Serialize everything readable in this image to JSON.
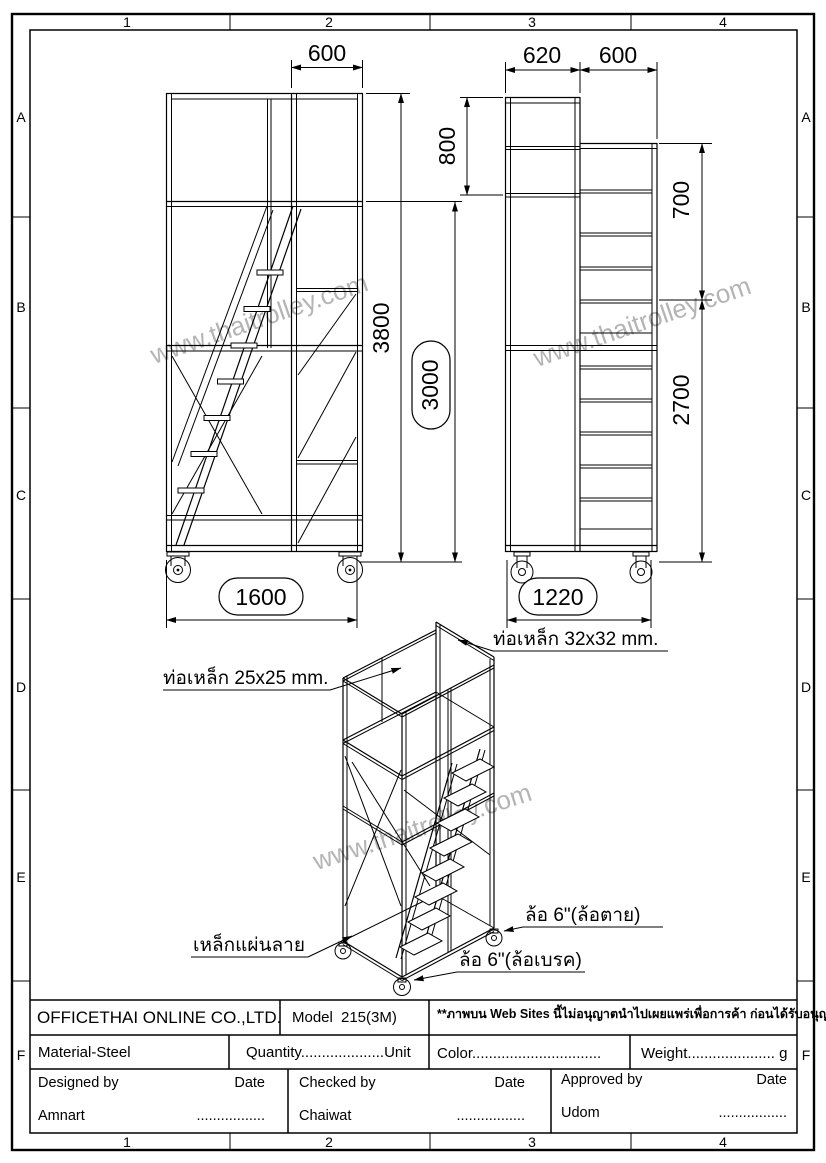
{
  "sheet": {
    "grid_cols": [
      "1",
      "2",
      "3",
      "4"
    ],
    "grid_rows": [
      "A",
      "B",
      "C",
      "D",
      "E",
      "F"
    ],
    "watermark": "www.thaitrolley.com"
  },
  "front_view": {
    "dim_top_width": "600",
    "dim_height_overall": "3800",
    "dim_height_platform": "3000",
    "dim_base_width": "1600"
  },
  "side_view": {
    "dim_top_depth": "620",
    "dim_top_width": "600",
    "dim_upper_left": "800",
    "dim_upper_right": "700",
    "dim_lower_right": "2700",
    "dim_base_depth": "1220"
  },
  "iso_view": {
    "label_tube_25": "ท่อเหล็ก 25x25 mm.",
    "label_tube_32": "ท่อเหล็ก 32x32 mm.",
    "label_plate": "เหล็กแผ่นลาย",
    "label_wheel_fixed": "ล้อ 6\"(ล้อตาย)",
    "label_wheel_brake": "ล้อ 6\"(ล้อเบรค)"
  },
  "title_block": {
    "company": "OFFICETHAI ONLINE CO.,LTD.",
    "model_label": "Model",
    "model_value": "215(3M)",
    "notice": "**ภาพบน Web Sites นี้ไม่อนุญาตนำไปเผยแพร่เพื่อการค้า ก่อนได้รับอนุญาต",
    "notice_color": "#ff0000",
    "material": "Material-Steel",
    "quantity": "Quantity....................Unit",
    "color": "Color...............................",
    "weight": "Weight..................... g",
    "designed_by_label": "Designed by",
    "designed_by_name": "Amnart",
    "checked_by_label": "Checked by",
    "checked_by_name": "Chaiwat",
    "approved_by_label": "Approved by",
    "approved_by_name": "Udom",
    "date_label": "Date",
    "date_dots": "................."
  }
}
